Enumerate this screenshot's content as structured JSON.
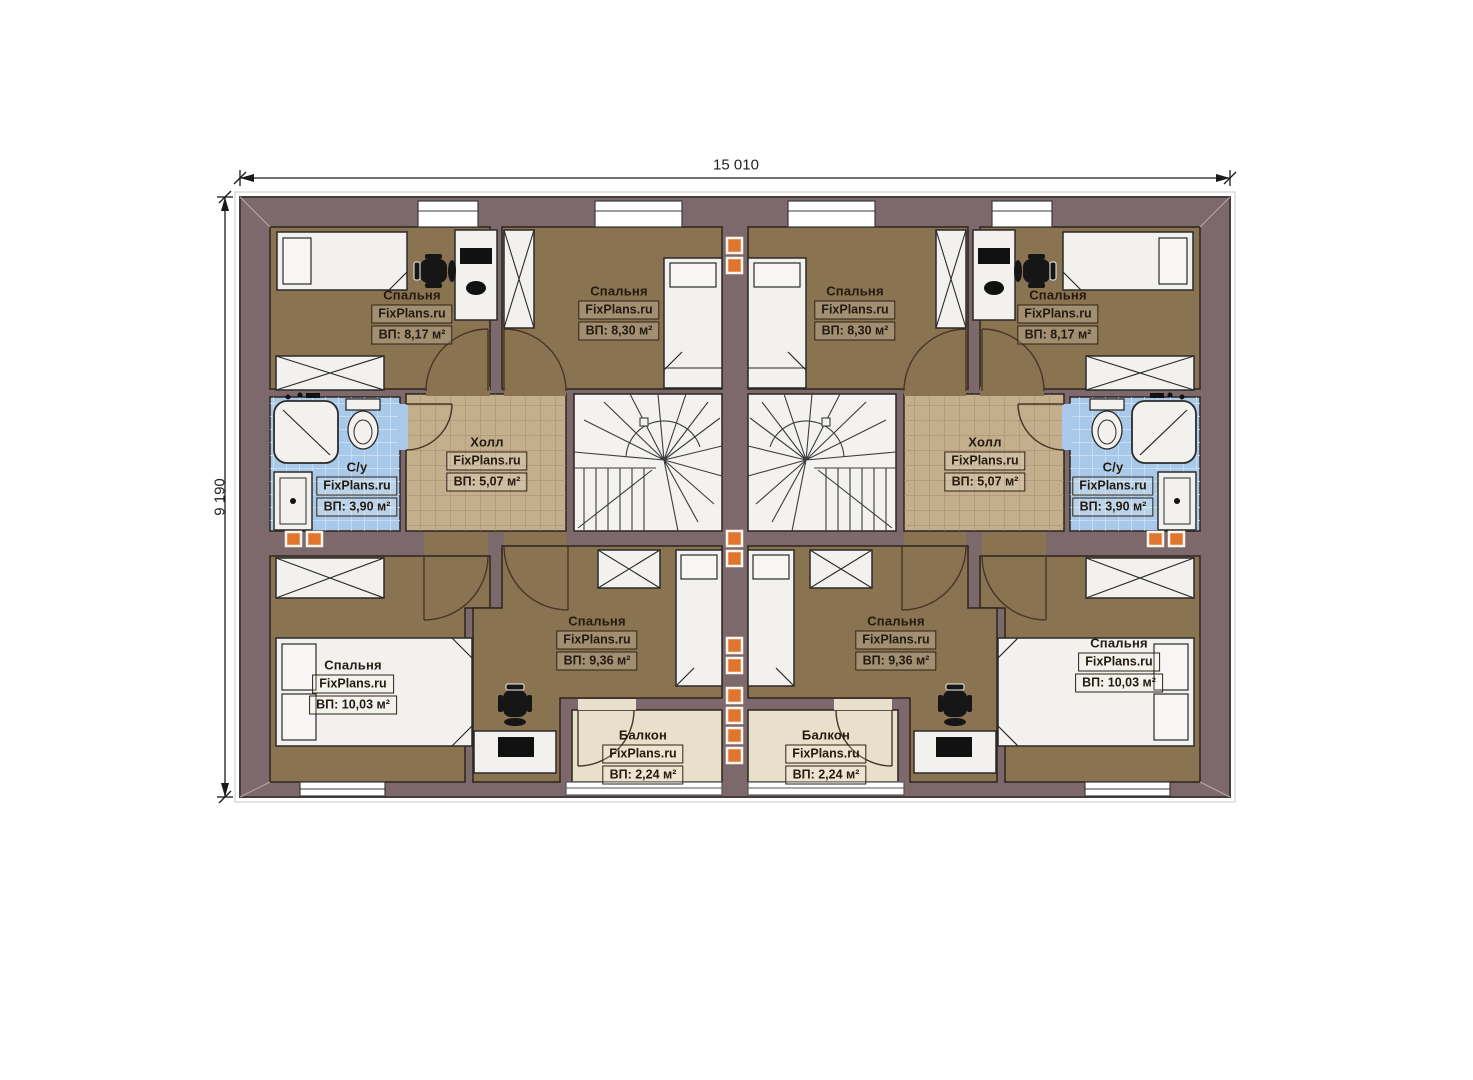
{
  "dimensions": {
    "width_label": "15 010",
    "height_label": "9 190"
  },
  "branding": {
    "watermark": "FixPlans.ru"
  },
  "colors": {
    "wall": "#7d686b",
    "wall_outline": "#463a3c",
    "bedroom_floor": "#8a7350",
    "hall_floor": "#c3af8c",
    "bath_floor": "#a8c9e9",
    "balcony_floor": "#e9e0cb",
    "stairs_floor": "#f3f2f0",
    "furniture": "#f2f1ee",
    "marker_orange": "#e0762e",
    "line_dark": "#2d241c"
  },
  "rooms": [
    {
      "name": "Спальня",
      "watermark": "FixPlans.ru",
      "area": "ВП: 8,17 м²"
    },
    {
      "name": "Спальня",
      "watermark": "FixPlans.ru",
      "area": "ВП: 8,30 м²"
    },
    {
      "name": "С/у",
      "watermark": "FixPlans.ru",
      "area": "ВП: 3,90 м²"
    },
    {
      "name": "Холл",
      "watermark": "FixPlans.ru",
      "area": "ВП: 5,07 м²"
    },
    {
      "name": "Спальня",
      "watermark": "FixPlans.ru",
      "area": "ВП: 9,36 м²"
    },
    {
      "name": "Спальня",
      "watermark": "FixPlans.ru",
      "area": "ВП: 10,03 м²"
    },
    {
      "name": "Балкон",
      "watermark": "FixPlans.ru",
      "area": "ВП: 2,24 м²"
    },
    {
      "name": "Спальня",
      "watermark": "FixPlans.ru",
      "area": "ВП: 8,30 м²"
    },
    {
      "name": "Спальня",
      "watermark": "FixPlans.ru",
      "area": "ВП: 8,17 м²"
    },
    {
      "name": "Холл",
      "watermark": "FixPlans.ru",
      "area": "ВП: 5,07 м²"
    },
    {
      "name": "С/у",
      "watermark": "FixPlans.ru",
      "area": "ВП: 3,90 м²"
    },
    {
      "name": "Спальня",
      "watermark": "FixPlans.ru",
      "area": "ВП: 9,36 м²"
    },
    {
      "name": "Спальня",
      "watermark": "FixPlans.ru",
      "area": "ВП: 10,03 м²"
    },
    {
      "name": "Балкон",
      "watermark": "FixPlans.ru",
      "area": "ВП: 2,24 м²"
    }
  ]
}
